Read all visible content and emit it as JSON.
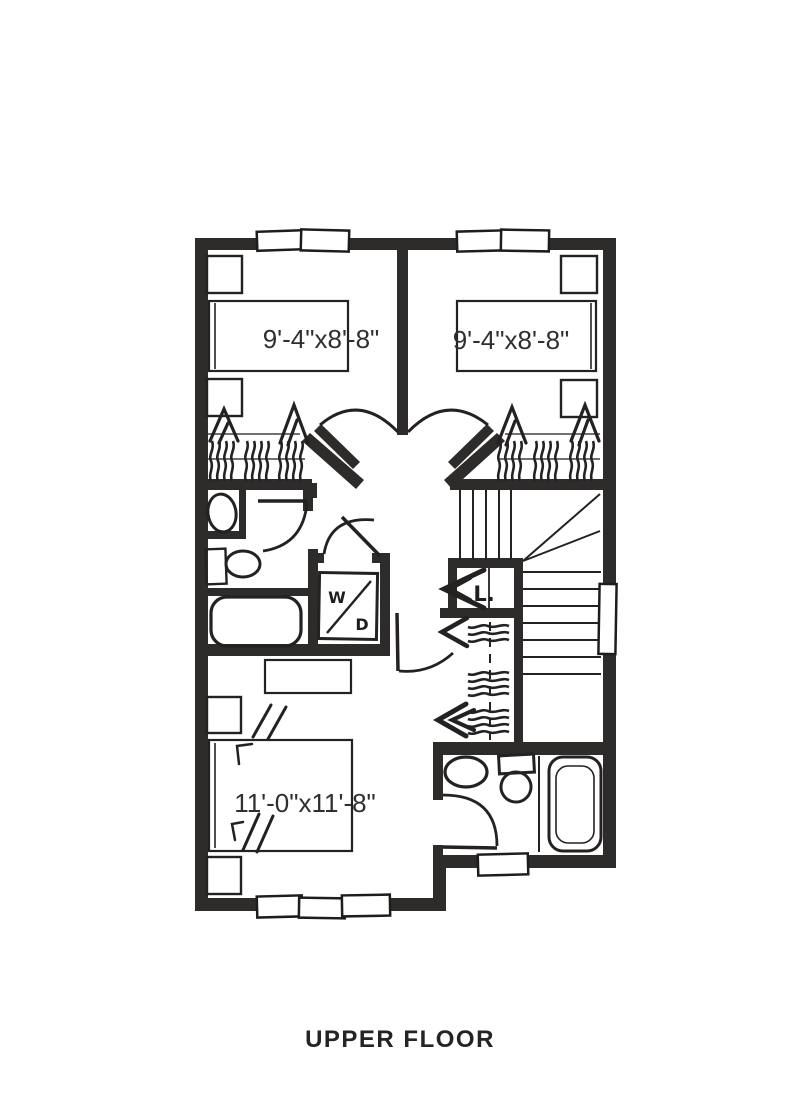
{
  "meta": {
    "floor_label": "UPPER FLOOR"
  },
  "plan": {
    "bedroom_left": {
      "dimension": "9'-4\"x8'-8\""
    },
    "bedroom_right": {
      "dimension": "9'-4\"x8'-8\""
    },
    "master_bedroom": {
      "dimension": "11'-0\"x11'-8\""
    },
    "laundry": {
      "letter_top": "W",
      "letter_bottom": "D"
    },
    "linen_closet": {
      "label": "L."
    },
    "colors": {
      "wall": "#2e2b2b",
      "line": "#242121",
      "background": "#ffffff",
      "dimension_text": "#2f2f2f",
      "title_text": "#262323"
    }
  }
}
